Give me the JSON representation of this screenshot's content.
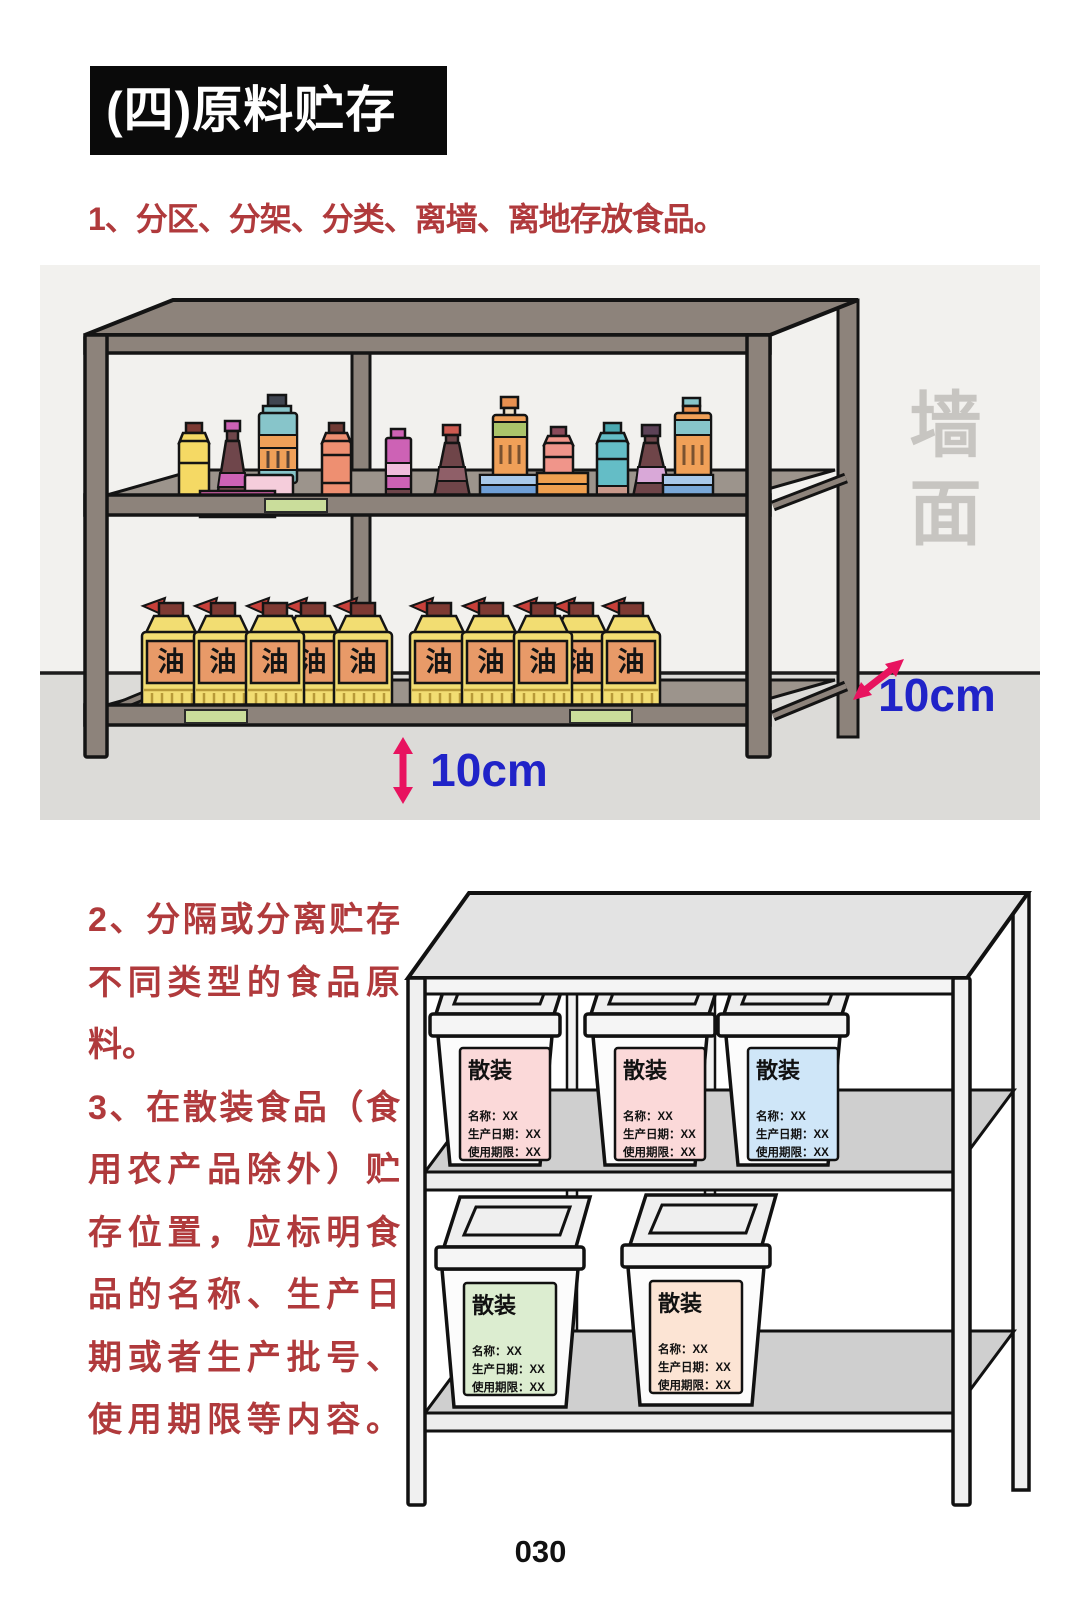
{
  "page": {
    "number": "030"
  },
  "header": {
    "title": "(四)原料贮存"
  },
  "item1": "1、分区、分架、分类、离墙、离地存放食品。",
  "left_notes": {
    "lines": [
      "2、分隔或分离贮存",
      "不同类型的食品原",
      "料。",
      "3、在散装食品（食",
      "用农产品除外）贮",
      "存位置，应标明食",
      "品的名称、生产日",
      "期或者生产批号、",
      "使用期限等内容。"
    ]
  },
  "illustration1": {
    "wall_label": "墙面",
    "seasoning_label": "调味品",
    "oil_label": "油",
    "wall_gap": "10cm",
    "floor_gap": "10cm"
  },
  "illustration2": {
    "bins": [
      {
        "tag": "散装",
        "name_line": "名称：XX",
        "date_line": "生产日期：XX",
        "expiry_line": "使用期限：XX",
        "label_color": "#fbd9d9"
      },
      {
        "tag": "散装",
        "name_line": "名称：XX",
        "date_line": "生产日期：XX",
        "expiry_line": "使用期限：XX",
        "label_color": "#fbd9d9"
      },
      {
        "tag": "散装",
        "name_line": "名称：XX",
        "date_line": "生产日期：XX",
        "expiry_line": "使用期限：XX",
        "label_color": "#cfe6f8"
      },
      {
        "tag": "散装",
        "name_line": "名称：XX",
        "date_line": "生产日期：XX",
        "expiry_line": "使用期限：XX",
        "label_color": "#dcedd0"
      },
      {
        "tag": "散装",
        "name_line": "名称：XX",
        "date_line": "生产日期：XX",
        "expiry_line": "使用期限：XX",
        "label_color": "#fce4d4"
      }
    ]
  },
  "colors": {
    "accent_red": "#b03a3c",
    "dim_blue": "#2023c8",
    "arrow_pink": "#e8135f",
    "frame_taupe": "#8d837b",
    "oil_yellow": "#f2dd72",
    "oil_label_orange": "#e89a68"
  }
}
